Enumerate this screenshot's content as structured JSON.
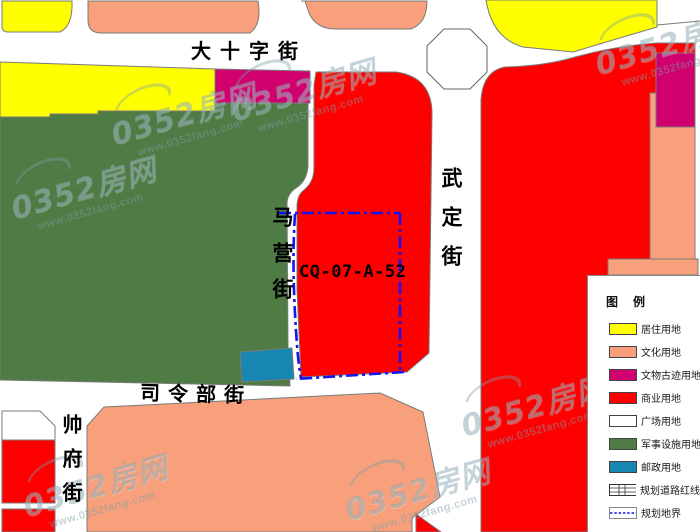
{
  "parcel": {
    "code": "CQ-07-A-52"
  },
  "streets": {
    "dashizijie": "大十字街",
    "wudingjie": "武定街",
    "mayingjie": "马营街",
    "silingbujie": "司令部街",
    "shuaifujie": "帅府街"
  },
  "watermark": {
    "brand": "0352房网",
    "url": "www.0352fang.com"
  },
  "legend": {
    "title": "图 例",
    "items": [
      {
        "label": "居住用地",
        "color": "#FFFF00",
        "css": "background:#FFFF00"
      },
      {
        "label": "文化用地",
        "color": "#F8A07C",
        "css": "background:#F8A07C"
      },
      {
        "label": "文物古迹用地",
        "color": "#D0006E",
        "css": "background:#D0006E"
      },
      {
        "label": "商业用地",
        "color": "#FF0000",
        "css": "background:#FF0000"
      },
      {
        "label": "广场用地",
        "color": "#FFFFFF",
        "css": "background:#FFFFFF"
      },
      {
        "label": "军事设施用地",
        "color": "#4F7B44",
        "css": "background:#4F7B44"
      },
      {
        "label": "邮政用地",
        "color": "#1787B2",
        "css": "background:#1787B2"
      },
      {
        "label": "规划道路红线",
        "color": "#333333",
        "css": ""
      },
      {
        "label": "规划地界",
        "color": "#1414F0",
        "css": ""
      }
    ]
  },
  "colors": {
    "residential": "#FFFF00",
    "cultural": "#F8A07C",
    "heritage": "#D0006E",
    "commercial": "#FE0000",
    "plaza": "#FFFFFF",
    "military": "#4F7B44",
    "postal": "#1787B2",
    "boundary_blue": "#1414F0",
    "road_edge_gray": "#7A7A7A"
  }
}
